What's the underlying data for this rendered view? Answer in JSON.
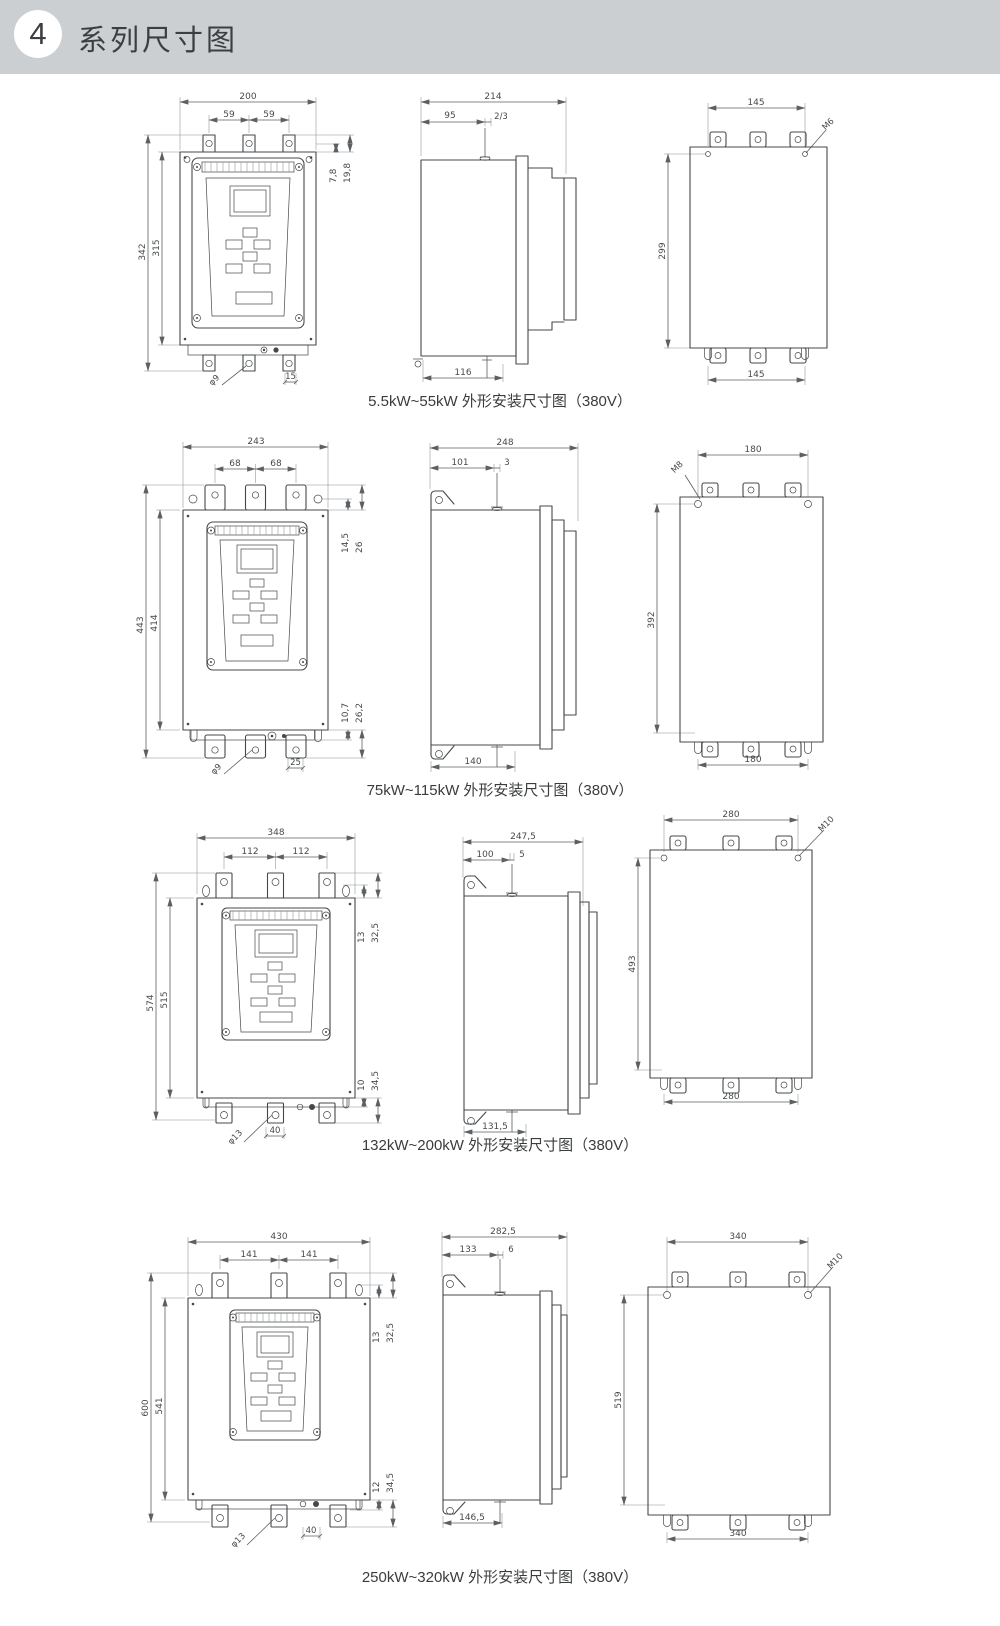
{
  "header": {
    "number": "4",
    "title": "系列尺寸图"
  },
  "sections": [
    {
      "caption": "5.5kW~55kW 外形安装尺寸图（380V）",
      "front": {
        "width": "200",
        "p1": "59",
        "p2": "59",
        "h1": "342",
        "h2": "315",
        "r1": "7,8",
        "r2": "19,8",
        "hole": "φ9",
        "slot": "15"
      },
      "side": {
        "depth": "214",
        "d1": "95",
        "d2": "2/3",
        "bottom": "116"
      },
      "back": {
        "top": "145",
        "screw": "M6",
        "height": "299",
        "bottom": "145"
      }
    },
    {
      "caption": "75kW~115kW 外形安装尺寸图（380V）",
      "front": {
        "width": "243",
        "p1": "68",
        "p2": "68",
        "h1": "443",
        "h2": "414",
        "r1": "14,5",
        "r2": "26",
        "rb1": "10,7",
        "rb2": "26,2",
        "hole": "φ9",
        "slot": "25"
      },
      "side": {
        "depth": "248",
        "d1": "101",
        "d2": "3",
        "bottom": "140"
      },
      "back": {
        "top": "180",
        "screw": "M8",
        "height": "392",
        "bottom": "180"
      }
    },
    {
      "caption": "132kW~200kW 外形安装尺寸图（380V）",
      "front": {
        "width": "348",
        "p1": "112",
        "p2": "112",
        "h1": "574",
        "h2": "515",
        "r1": "13",
        "r2": "32,5",
        "rb1": "10",
        "rb2": "34,5",
        "hole": "φ13",
        "slot": "40"
      },
      "side": {
        "depth": "247,5",
        "d1": "100",
        "d2": "5",
        "bottom": "131,5"
      },
      "back": {
        "top": "280",
        "screw": "M10",
        "height": "493",
        "bottom": "280"
      }
    },
    {
      "caption": "250kW~320kW 外形安装尺寸图（380V）",
      "front": {
        "width": "430",
        "p1": "141",
        "p2": "141",
        "h1": "600",
        "h2": "541",
        "r1": "13",
        "r2": "32,5",
        "rb1": "12",
        "rb2": "34,5",
        "hole": "φ13",
        "slot": "40"
      },
      "side": {
        "depth": "282,5",
        "d1": "133",
        "d2": "6",
        "bottom": "146,5"
      },
      "back": {
        "top": "340",
        "screw": "M10",
        "height": "519",
        "bottom": "340"
      }
    }
  ]
}
